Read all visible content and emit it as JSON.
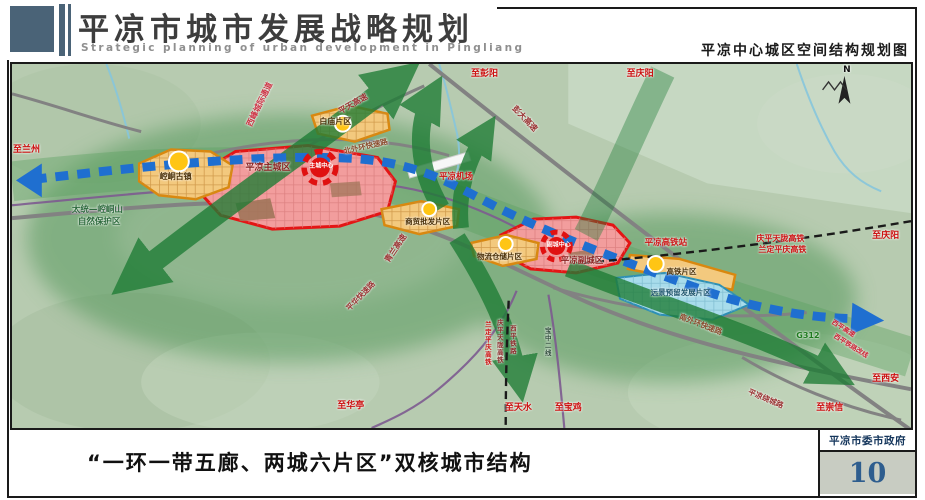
{
  "header": {
    "title_cn": "平凉市城市发展战略规划",
    "title_en": "Strategic planning of urban development in Pingliang",
    "right_caption": "平凉中心城区空间结构规划图"
  },
  "footer": {
    "caption": "“一环一带五廊、两城六片区”双核城市结构",
    "agency": "平凉市委市政府",
    "page_number": "10"
  },
  "map": {
    "colors": {
      "terrain": "#b7cbb0",
      "eco_green": "#4e9455",
      "corridor_green": "#1e7c35",
      "axis_blue": "#1f6fd0",
      "main_city_red": "#e31515",
      "zone_orange": "#d9880f",
      "reserve_blue": "#2d8fb5"
    },
    "labels": [
      {
        "name": "north-label",
        "text": "N",
        "x": 833,
        "y": 1,
        "color": "#111111",
        "size": 9
      },
      {
        "name": "to-lanzhou-label",
        "text": "至兰州",
        "x": 1,
        "y": 81,
        "color": "#cc1111",
        "size": 9
      },
      {
        "name": "xifeng-intercity-label",
        "text": "西峰城际通道",
        "x": 234,
        "y": 60,
        "color": "#cc3344",
        "size": 8,
        "rotate": -64
      },
      {
        "name": "pingtian-expressway-label",
        "text": "平天高速",
        "x": 326,
        "y": 44,
        "color": "#9a3333",
        "size": 8,
        "rotate": -30
      },
      {
        "name": "to-pengyang-label",
        "text": "至彭阳",
        "x": 460,
        "y": 5,
        "color": "#cc1111",
        "size": 9
      },
      {
        "name": "to-qingyang-north-label",
        "text": "至庆阳",
        "x": 616,
        "y": 5,
        "color": "#cc1111",
        "size": 9
      },
      {
        "name": "pengda-expressway-label",
        "text": "彭大高速",
        "x": 506,
        "y": 40,
        "color": "#9a3333",
        "size": 8,
        "rotate": 46
      },
      {
        "name": "north-ring-road-label",
        "text": "北外环快速路",
        "x": 332,
        "y": 84,
        "color": "#8a4a2c",
        "size": 7.5,
        "rotate": -13
      },
      {
        "name": "baimiao-district-label",
        "text": "白庙片区",
        "x": 308,
        "y": 53,
        "color": "#4a3008",
        "size": 8
      },
      {
        "name": "main-city-label",
        "text": "平凉主城区",
        "x": 234,
        "y": 100,
        "color": "#8a1f1f",
        "size": 9
      },
      {
        "name": "main-city-center-label",
        "text": "主城中心",
        "x": 310,
        "y": 104,
        "color": "#ffffff",
        "size": 6,
        "center": true
      },
      {
        "name": "airport-label",
        "text": "平凉机场",
        "x": 428,
        "y": 110,
        "color": "#cc1111",
        "size": 8.5
      },
      {
        "name": "nature-reserve-label-1",
        "text": "太统—崆峒山",
        "x": 60,
        "y": 143,
        "color": "#2e6b3e",
        "size": 8.5
      },
      {
        "name": "nature-reserve-label-2",
        "text": "自然保护区",
        "x": 66,
        "y": 155,
        "color": "#2e6b3e",
        "size": 8.5
      },
      {
        "name": "kongtong-town-label",
        "text": "崆峒古镇",
        "x": 148,
        "y": 109,
        "color": "#4a3008",
        "size": 8
      },
      {
        "name": "trade-wholesale-district-label",
        "text": "商贸批发片区",
        "x": 394,
        "y": 155,
        "color": "#4a3008",
        "size": 7.5
      },
      {
        "name": "qinglan-expressway-label",
        "text": "青兰高速",
        "x": 372,
        "y": 196,
        "color": "#9a3333",
        "size": 8,
        "rotate": -56
      },
      {
        "name": "logistics-district-label",
        "text": "物流仓储片区",
        "x": 466,
        "y": 190,
        "color": "#4a3008",
        "size": 7.5
      },
      {
        "name": "sub-city-center-label",
        "text": "副城中心",
        "x": 548,
        "y": 183,
        "color": "#ffffff",
        "size": 6,
        "center": true
      },
      {
        "name": "sub-city-label",
        "text": "平凉副城区",
        "x": 550,
        "y": 194,
        "color": "#8a1f1f",
        "size": 8.5
      },
      {
        "name": "hsr-station-label",
        "text": "平凉高铁站",
        "x": 634,
        "y": 176,
        "color": "#cc1111",
        "size": 8.5
      },
      {
        "name": "hsr-line1-label",
        "text": "庆平天陇高铁",
        "x": 746,
        "y": 171,
        "color": "#cc1111",
        "size": 8
      },
      {
        "name": "hsr-line2-label",
        "text": "兰定平庆高铁",
        "x": 748,
        "y": 182,
        "color": "#cc1111",
        "size": 8
      },
      {
        "name": "to-qingyang-east-label",
        "text": "至庆阳",
        "x": 862,
        "y": 168,
        "color": "#cc1111",
        "size": 9
      },
      {
        "name": "hsr-district-label",
        "text": "高铁片区",
        "x": 656,
        "y": 205,
        "color": "#4a3008",
        "size": 7.5
      },
      {
        "name": "future-reserve-district-label",
        "text": "远景预留发展片区",
        "x": 640,
        "y": 226,
        "color": "#1f566e",
        "size": 7.5
      },
      {
        "name": "south-ring-road-label",
        "text": "南外环快速路",
        "x": 670,
        "y": 250,
        "color": "#8a4a2c",
        "size": 7.5,
        "rotate": 21
      },
      {
        "name": "pinghua-expressway-label",
        "text": "平华快速路",
        "x": 334,
        "y": 244,
        "color": "#9a3333",
        "size": 7.5,
        "rotate": -46
      },
      {
        "name": "to-huating-label",
        "text": "至华亭",
        "x": 326,
        "y": 339,
        "color": "#cc1111",
        "size": 9
      },
      {
        "name": "landing-rail1-label",
        "text": "兰定平庆高铁",
        "x": 472,
        "y": 258,
        "color": "#cc1111",
        "size": 6.5,
        "vertical": true
      },
      {
        "name": "landing-rail2-label",
        "text": "庆平天陇高铁",
        "x": 484,
        "y": 256,
        "color": "#8a2a2a",
        "size": 6.5,
        "vertical": true
      },
      {
        "name": "xiping-railway-label",
        "text": "西平铁路",
        "x": 497,
        "y": 262,
        "color": "#8a2a2a",
        "size": 6.5,
        "vertical": true
      },
      {
        "name": "baozhong-line-label",
        "text": "宝中二线",
        "x": 532,
        "y": 264,
        "color": "#2e4a3a",
        "size": 6.5,
        "vertical": true
      },
      {
        "name": "to-tianshui-label",
        "text": "至天水",
        "x": 494,
        "y": 341,
        "color": "#cc1111",
        "size": 9
      },
      {
        "name": "to-baoji-label",
        "text": "至宝鸡",
        "x": 544,
        "y": 341,
        "color": "#cc1111",
        "size": 9
      },
      {
        "name": "g312-label",
        "text": "G312",
        "x": 786,
        "y": 268,
        "color": "#1e7a1e",
        "size": 8
      },
      {
        "name": "xiping-expressway-label",
        "text": "西平高速",
        "x": 824,
        "y": 256,
        "color": "#cc2233",
        "size": 6.5,
        "rotate": 32
      },
      {
        "name": "xiping-reroute-label",
        "text": "西平铁路改线",
        "x": 826,
        "y": 270,
        "color": "#cc2233",
        "size": 6.5,
        "rotate": 32
      },
      {
        "name": "to-xian-label",
        "text": "至西安",
        "x": 862,
        "y": 312,
        "color": "#cc1111",
        "size": 9
      },
      {
        "name": "ring-road-label",
        "text": "平凉绕城路",
        "x": 740,
        "y": 326,
        "color": "#9a3333",
        "size": 7.5,
        "rotate": 23
      },
      {
        "name": "to-chongxin-label",
        "text": "至崇信",
        "x": 806,
        "y": 341,
        "color": "#cc1111",
        "size": 9
      }
    ]
  }
}
